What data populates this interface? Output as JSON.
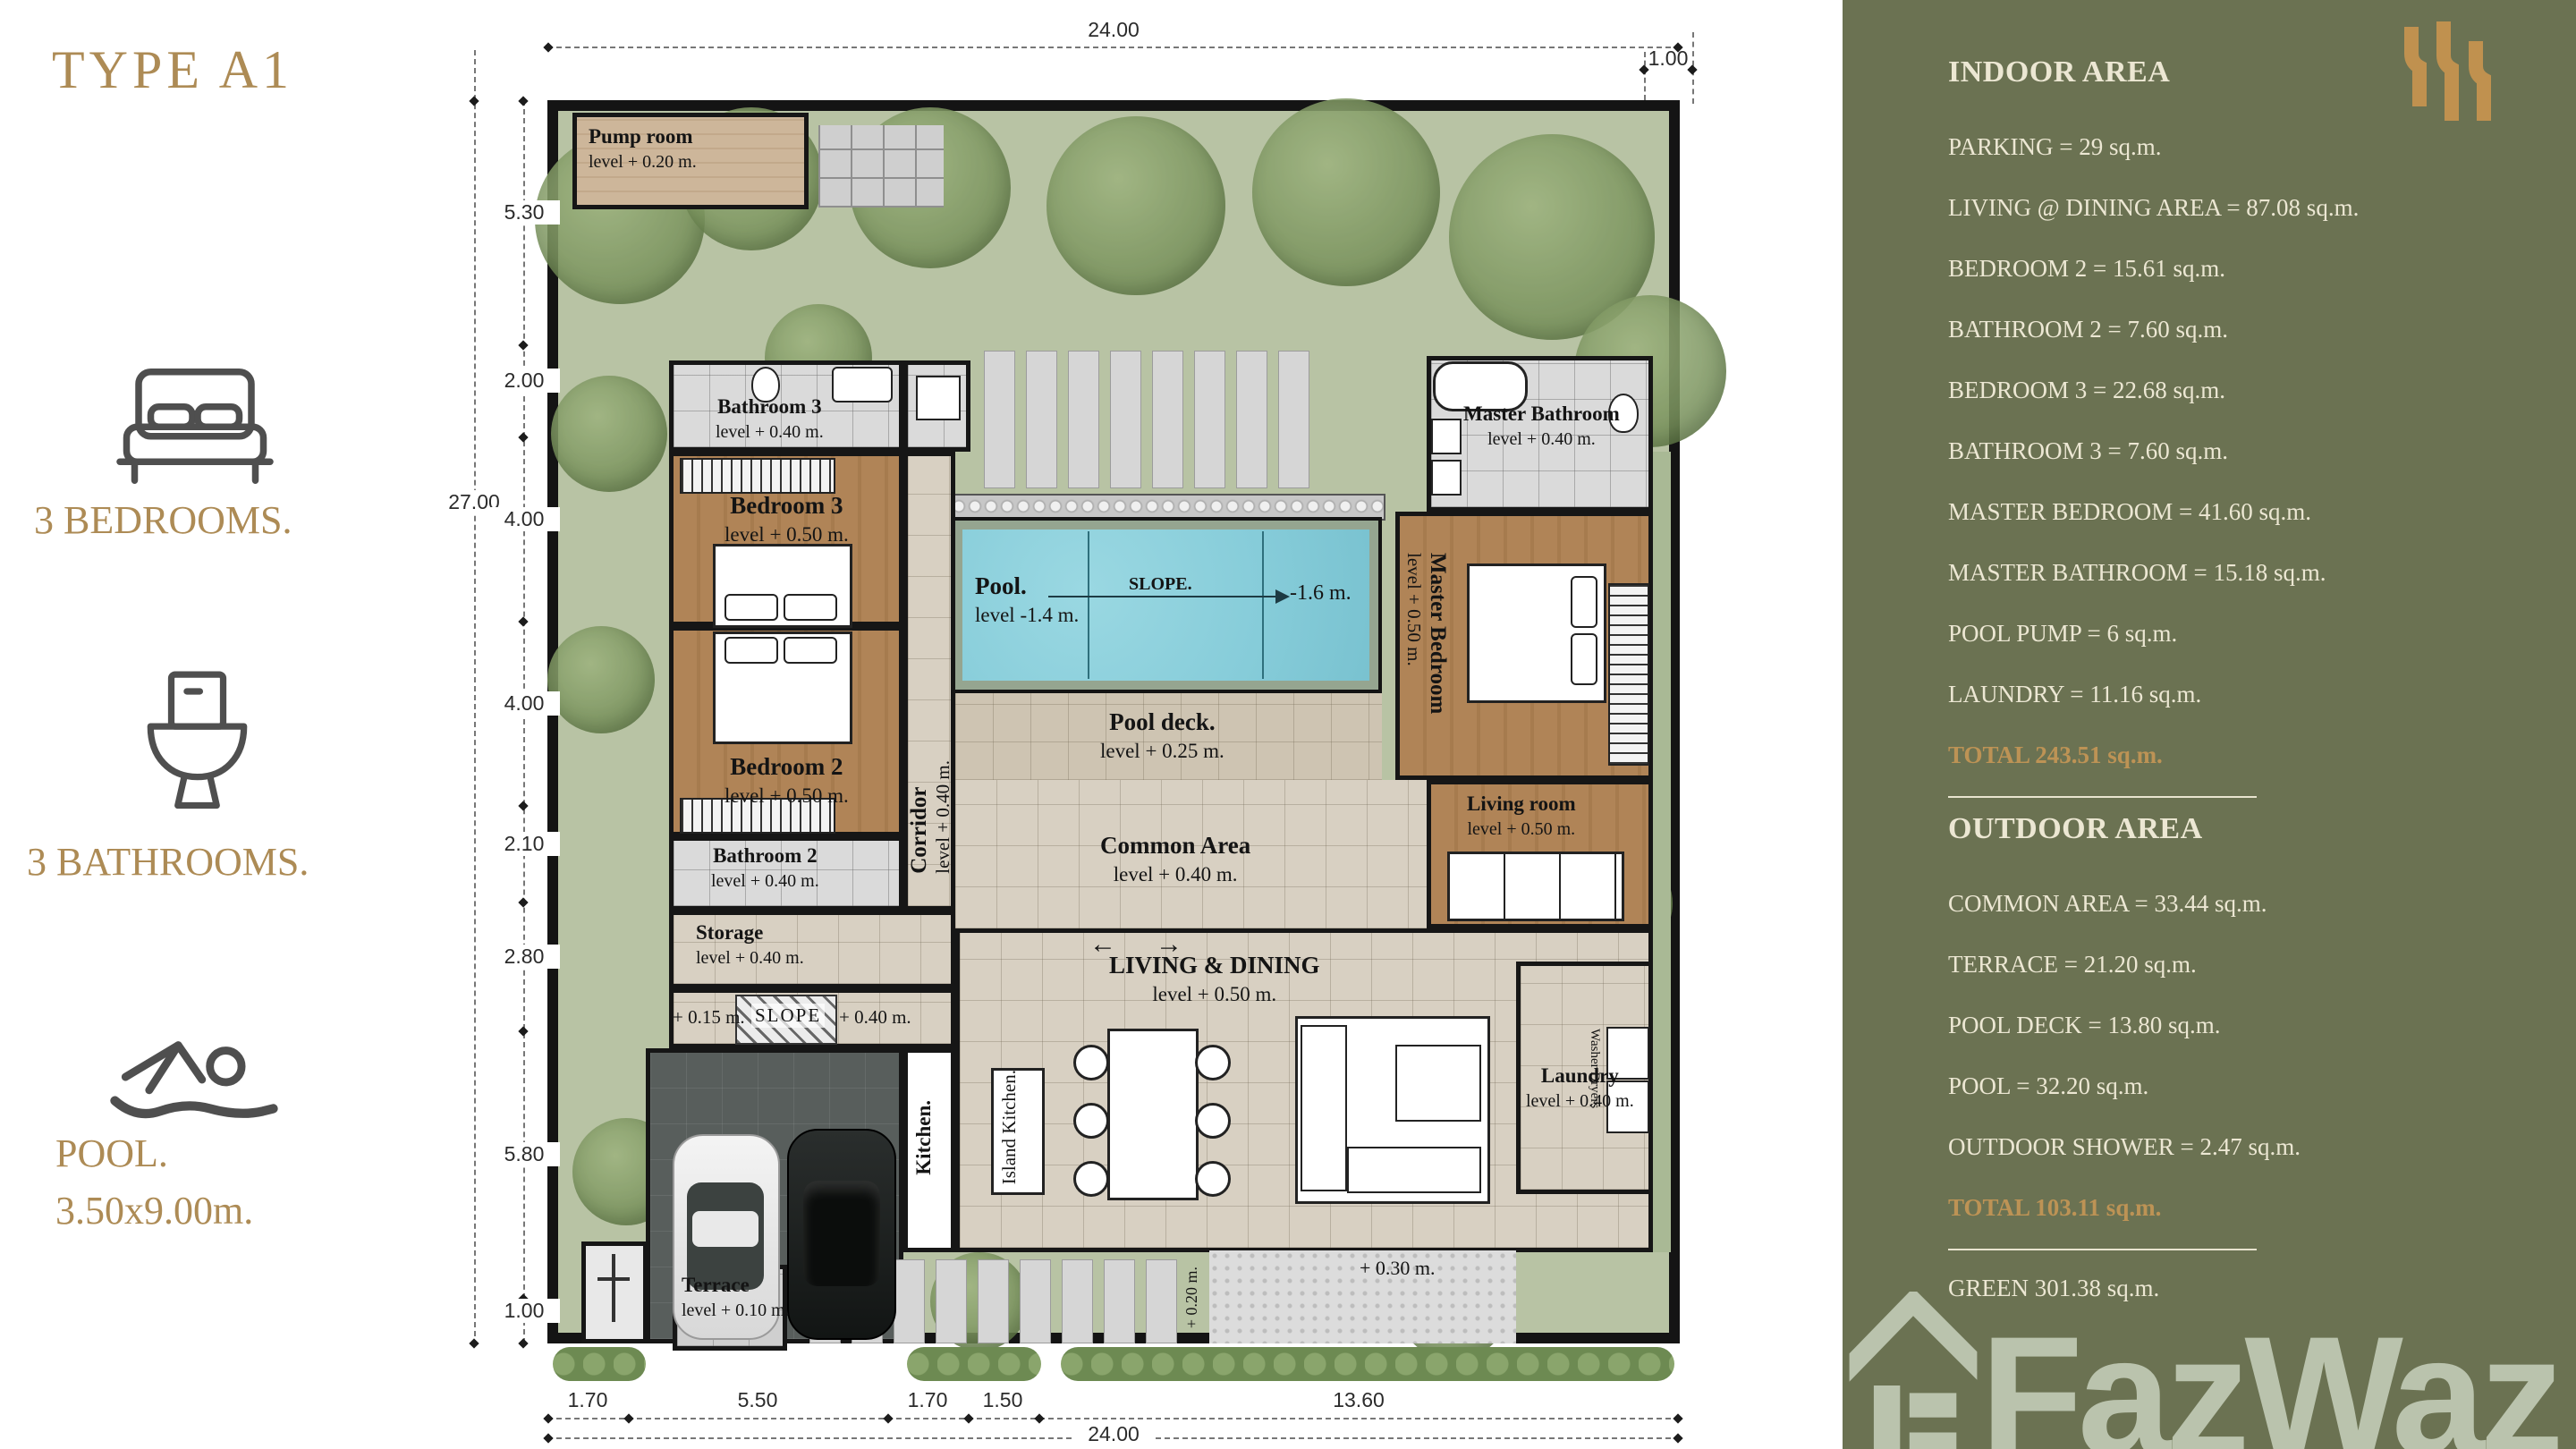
{
  "page": {
    "title": "TYPE A1"
  },
  "features": {
    "bedrooms": "3 BEDROOMS.",
    "bathrooms": "3 BATHROOMS.",
    "pool_line1": "POOL.",
    "pool_line2": "3.50x9.00m."
  },
  "panel": {
    "colors": {
      "background": "#6b7252",
      "text": "#ece7d3",
      "accent_gold": "#bd9355"
    },
    "indoor": {
      "heading": "INDOOR AREA",
      "items": [
        "PARKING = 29 sq.m.",
        "LIVING @ DINING AREA = 87.08 sq.m.",
        "BEDROOM 2 = 15.61 sq.m.",
        "BATHROOM 2 = 7.60 sq.m.",
        "BEDROOM 3 = 22.68 sq.m.",
        "BATHROOM 3 = 7.60 sq.m.",
        "MASTER BEDROOM = 41.60 sq.m.",
        "MASTER BATHROOM = 15.18 sq.m.",
        "POOL PUMP = 6 sq.m.",
        "LAUNDRY = 11.16 sq.m."
      ],
      "total": "TOTAL 243.51 sq.m."
    },
    "outdoor": {
      "heading": "OUTDOOR AREA",
      "items": [
        "COMMON AREA = 33.44 sq.m.",
        "TERRACE = 21.20  sq.m.",
        "POOL DECK = 13.80  sq.m.",
        "POOL = 32.20 sq.m.",
        "OUTDOOR SHOWER = 2.47 sq.m."
      ],
      "total": "TOTAL 103.11 sq.m."
    },
    "green": "GREEN 301.38 sq.m.",
    "watermark": "FazWaz"
  },
  "plan": {
    "rooms": {
      "pump": {
        "name": "Pump room",
        "level": "level + 0.20 m."
      },
      "bathroom3": {
        "name": "Bathroom 3",
        "level": "level + 0.40 m."
      },
      "bedroom3": {
        "name": "Bedroom 3",
        "level": "level + 0.50 m."
      },
      "bedroom2": {
        "name": "Bedroom 2",
        "level": "level + 0.50 m."
      },
      "bathroom2": {
        "name": "Bathroom 2",
        "level": "level + 0.40 m."
      },
      "storage": {
        "name": "Storage",
        "level": "level + 0.40 m."
      },
      "corridor": {
        "name": "Corridor",
        "level": "level + 0.40 m."
      },
      "kitchen": {
        "name": "Kitchen."
      },
      "island": {
        "name": "Island Kitchen."
      },
      "living_dining": {
        "name": "LIVING & DINING",
        "level": "level + 0.50 m."
      },
      "laundry": {
        "name": "Laundry",
        "level": "level + 0.40 m."
      },
      "living_room": {
        "name": "Living room",
        "level": "level + 0.50 m."
      },
      "master_bedroom": {
        "name": "Master Bedroom",
        "level": "level + 0.50 m."
      },
      "master_bathroom": {
        "name": "Master Bathroom",
        "level": "level + 0.40 m."
      },
      "pool": {
        "name": "Pool.",
        "level": "level -1.4 m."
      },
      "pool_deck": {
        "name": "Pool deck.",
        "level": "level + 0.25 m."
      },
      "common": {
        "name": "Common Area",
        "level": "level + 0.40 m."
      },
      "terrace": {
        "name": "Terrace",
        "level": "level + 0.10 m."
      }
    },
    "annotations": {
      "slope_pool": "SLOPE.",
      "pool_depth": "-1.6 m.",
      "ramp_left": "+ 0.15 m.",
      "ramp": "SLOPE",
      "ramp_right": "+ 0.40 m.",
      "washer": "Washer Dryers",
      "yard": "+ 0.30 m.",
      "path": "+ 0.20 m.",
      "arrow_left": "←",
      "arrow_right": "→"
    },
    "dims": {
      "top_total": "24.00",
      "top_right": "1.00",
      "left_total": "27.00",
      "left_segments": [
        "5.30",
        "2.00",
        "4.00",
        "4.00",
        "2.10",
        "2.80",
        "5.80",
        "1.00"
      ],
      "bottom_segments": [
        "1.70",
        "5.50",
        "1.70",
        "1.50",
        "13.60"
      ],
      "bottom_total": "24.00"
    }
  }
}
